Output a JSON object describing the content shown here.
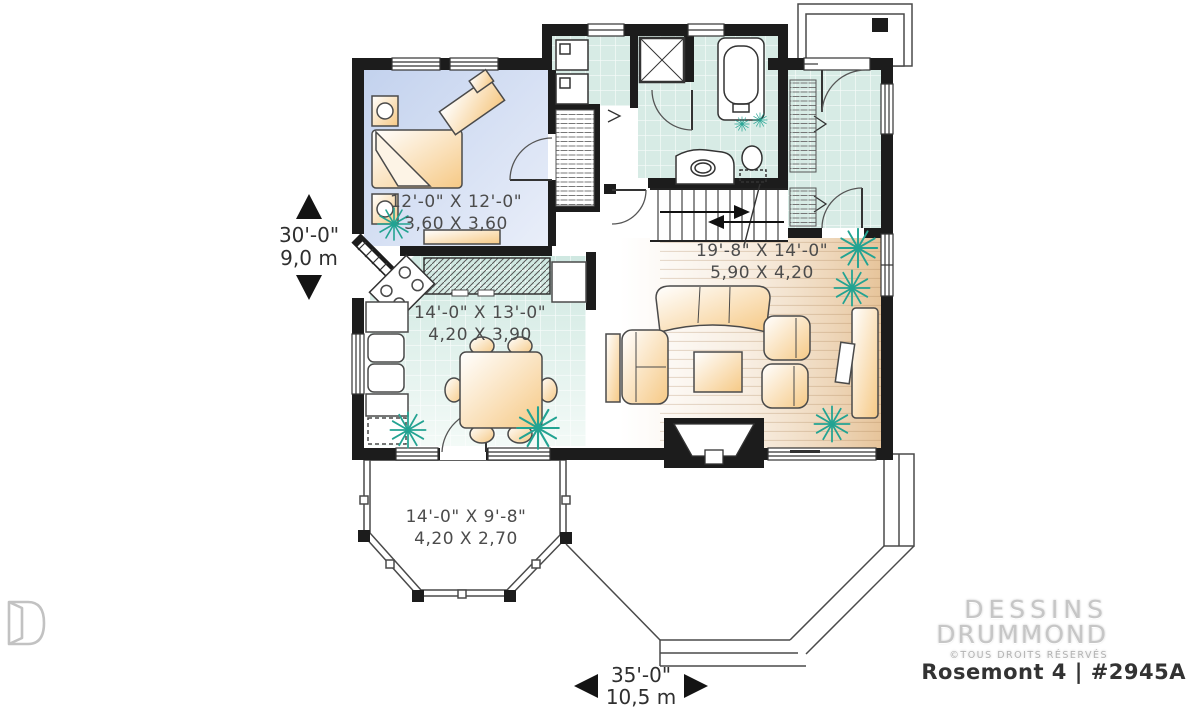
{
  "plan": {
    "rooms": {
      "bedroom": {
        "imperial": "12'-0\" X 12'-0\"",
        "metric": "3,60 X 3,60"
      },
      "dining": {
        "imperial": "14'-0\" X 13'-0\"",
        "metric": "4,20 X 3,90"
      },
      "living": {
        "imperial": "19'-8\" X 14'-0\"",
        "metric": "5,90 X 4,20"
      },
      "porch": {
        "imperial": "14'-0\" X 9'-8\"",
        "metric": "4,20 X 2,70"
      }
    },
    "overall": {
      "depth": {
        "imperial": "30'-0\"",
        "metric": "9,0 m"
      },
      "width": {
        "imperial": "35'-0\"",
        "metric": "10,5 m"
      }
    }
  },
  "branding": {
    "logo_line1": "DESSINS",
    "logo_line2": "DRUMMOND",
    "rights": "©TOUS DROITS RÉSERVÉS",
    "plan_name": "Rosemont 4 | #2945A"
  },
  "colors": {
    "wall": "#1c1c1c",
    "tile_floor": "#d7ebe5",
    "bedroom_floor": "#ccd9ee",
    "wood_floor": "#e9cda8",
    "furniture": "#f8d29b",
    "plant": "#23a392",
    "label_text": "#4c4c4c"
  }
}
